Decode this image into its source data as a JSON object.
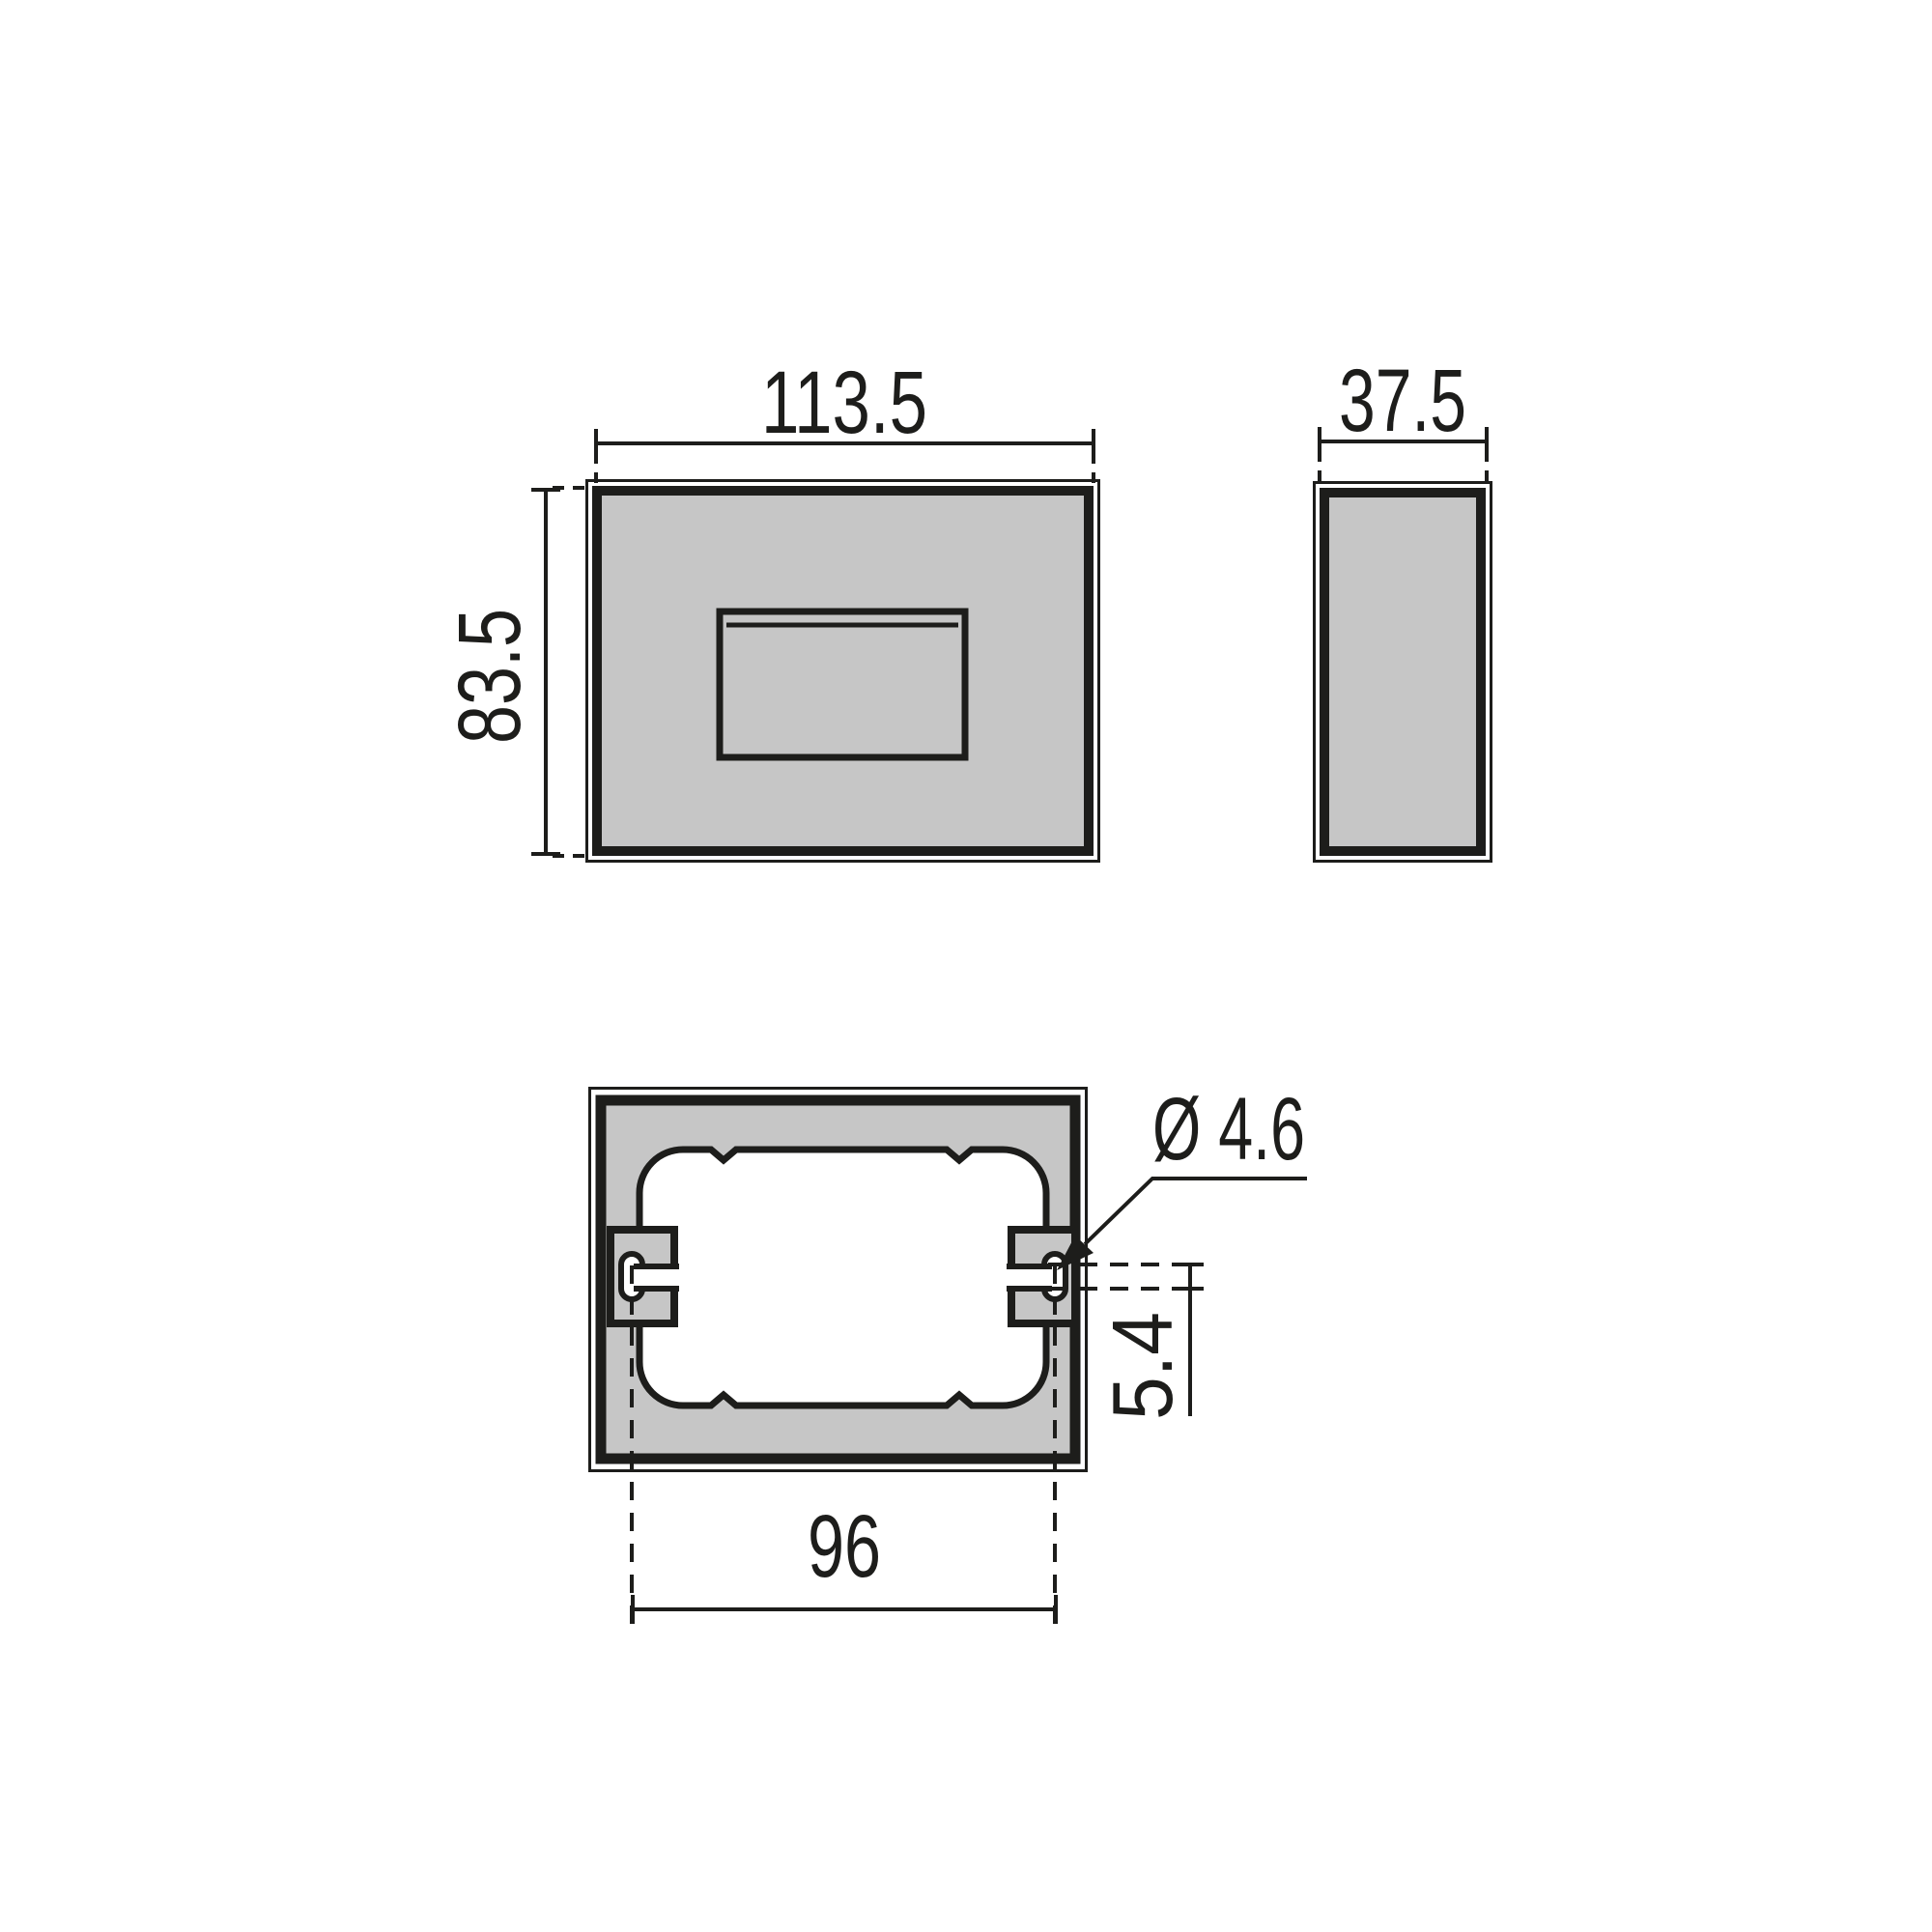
{
  "drawing": {
    "front_view": {
      "width_label": "113.5",
      "height_label": "83.5"
    },
    "side_view": {
      "depth_label": "37.5"
    },
    "back_view": {
      "hole_spacing_label": "96",
      "hole_diameter_label": "Ø 4.6",
      "hole_offset_label": "5.4"
    }
  },
  "colors": {
    "background": "#ffffff",
    "part_fill": "#c6c6c6",
    "cutout_fill": "#ffffff",
    "line": "#1d1d1b"
  }
}
